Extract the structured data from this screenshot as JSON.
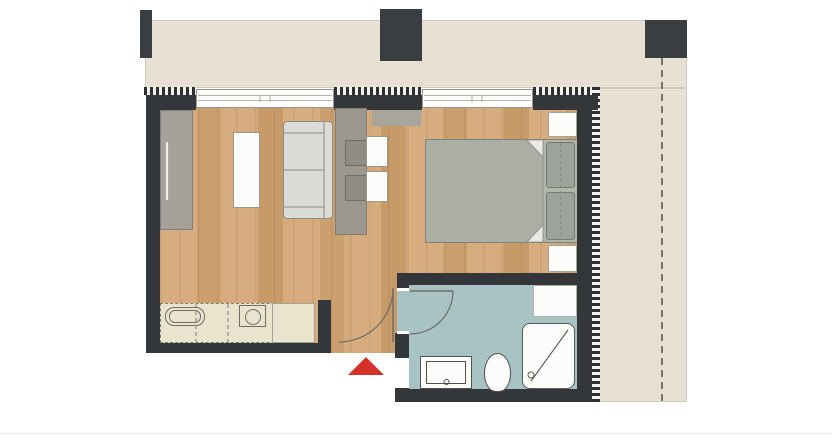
{
  "plan": {
    "title": "studio-apartment-floor-plan",
    "canvas": {
      "width": 832,
      "height": 441
    },
    "palette": {
      "bg": "#ffffff",
      "terrace": "#e7e0d3",
      "wall": "#34373a",
      "column": "#3b3e41",
      "tile": "#a8c3c3",
      "white": "#fcfcfa",
      "wardrobe": "#a4a19a",
      "partition": "#9b988f",
      "chair": "#8e8c83",
      "sofa": "#dcdcd7",
      "bed": "#abafa3",
      "bedHead": "#b2b6aa",
      "pillow": "#9da29a",
      "counter": "#eae4cf",
      "red": "#d5312a",
      "line": "#6d6d66"
    },
    "shapes": [
      {
        "name": "terrace-top",
        "x": 145,
        "y": 20,
        "w": 542,
        "h": 68,
        "cls": "terrace"
      },
      {
        "name": "terrace-right",
        "x": 598,
        "y": 88,
        "w": 89,
        "h": 314,
        "cls": "terrace"
      },
      {
        "name": "column-1",
        "x": 140,
        "y": 10,
        "w": 12,
        "h": 48,
        "fill": "$column"
      },
      {
        "name": "column-2",
        "x": 380,
        "y": 9,
        "w": 42,
        "h": 52,
        "fill": "$column"
      },
      {
        "name": "column-3",
        "x": 645,
        "y": 20,
        "w": 42,
        "h": 38,
        "fill": "$column"
      },
      {
        "name": "wood-floor",
        "x": 160,
        "y": 108,
        "w": 418,
        "h": 245,
        "cls": "wood"
      },
      {
        "name": "hatch-top-left",
        "x": 144,
        "y": 87,
        "w": 52,
        "h": 8,
        "cls": "hatch-h"
      },
      {
        "name": "hatch-top-mid",
        "x": 334,
        "y": 87,
        "w": 88,
        "h": 8,
        "cls": "hatch-h"
      },
      {
        "name": "hatch-top-right",
        "x": 533,
        "y": 87,
        "w": 66,
        "h": 8,
        "cls": "hatch-h"
      },
      {
        "name": "hatch-right",
        "x": 592,
        "y": 87,
        "w": 8,
        "h": 315,
        "cls": "hatch-v"
      },
      {
        "name": "wall-top-left",
        "x": 146,
        "y": 95,
        "w": 50,
        "h": 15,
        "fill": "$wall"
      },
      {
        "name": "wall-top-mid",
        "x": 334,
        "y": 95,
        "w": 88,
        "h": 15,
        "fill": "$wall"
      },
      {
        "name": "wall-top-right",
        "x": 533,
        "y": 95,
        "w": 65,
        "h": 15,
        "fill": "$wall"
      },
      {
        "name": "wall-left",
        "x": 146,
        "y": 95,
        "w": 14,
        "h": 258,
        "fill": "$wall"
      },
      {
        "name": "wall-kitchen-south",
        "x": 146,
        "y": 343,
        "w": 185,
        "h": 10,
        "fill": "$wall"
      },
      {
        "name": "wall-entry-stub",
        "x": 318,
        "y": 300,
        "w": 13,
        "h": 53,
        "fill": "$wall"
      },
      {
        "name": "wall-right",
        "x": 577,
        "y": 95,
        "w": 15,
        "h": 307,
        "fill": "$wall"
      },
      {
        "name": "wall-bath-north",
        "x": 397,
        "y": 273,
        "w": 181,
        "h": 12,
        "fill": "$wall"
      },
      {
        "name": "wall-bath-west-upper",
        "x": 397,
        "y": 285,
        "w": 12,
        "h": 6,
        "fill": "$wall"
      },
      {
        "name": "wall-bath-west-stub",
        "x": 395,
        "y": 333,
        "w": 16,
        "h": 25,
        "fill": "$wall"
      },
      {
        "name": "wall-bath-south",
        "x": 395,
        "y": 388,
        "w": 197,
        "h": 14,
        "fill": "$wall"
      },
      {
        "name": "window-1",
        "x": 196,
        "y": 89,
        "w": 138,
        "h": 19,
        "k": "window"
      },
      {
        "name": "window-2",
        "x": 422,
        "y": 89,
        "w": 111,
        "h": 19,
        "k": "window"
      },
      {
        "name": "bathroom-floor",
        "x": 409,
        "y": 285,
        "w": 168,
        "h": 104,
        "fill": "$tile"
      },
      {
        "name": "bathroom-doorway-floor",
        "x": 397,
        "y": 291,
        "w": 12,
        "h": 41,
        "fill": "$tile"
      },
      {
        "name": "bathroom-door-jamb-top",
        "x": 397,
        "y": 288,
        "w": 12,
        "h": 3,
        "fill": "$white"
      },
      {
        "name": "bathroom-door-jamb-bottom",
        "x": 397,
        "y": 331,
        "w": 12,
        "h": 3,
        "fill": "$white"
      },
      {
        "name": "wardrobe",
        "x": 160,
        "y": 110,
        "w": 33,
        "h": 120,
        "fill": "$wardrobe",
        "border": "1px solid #83807a"
      },
      {
        "name": "coffee-table",
        "x": 233,
        "y": 132,
        "w": 27,
        "h": 76,
        "fill": "$white",
        "border": "1px solid #9a988e"
      },
      {
        "name": "sofa",
        "x": 283,
        "y": 121,
        "w": 50,
        "h": 98,
        "fill": "$sofa",
        "border": "1px solid #8d8d86",
        "radius": "4px"
      },
      {
        "name": "partition-unit",
        "x": 335,
        "y": 108,
        "w": 32,
        "h": 127,
        "fill": "$partition",
        "border": "1px solid #807d75"
      },
      {
        "name": "wall-cabinet",
        "x": 372,
        "y": 110,
        "w": 49,
        "h": 16,
        "fill": "#a8a59c"
      },
      {
        "name": "chair-1",
        "x": 345,
        "y": 140,
        "w": 26,
        "h": 26,
        "fill": "$chair",
        "border": "1px solid #6f6d64"
      },
      {
        "name": "chair-2",
        "x": 345,
        "y": 175,
        "w": 26,
        "h": 26,
        "fill": "$chair",
        "border": "1px solid #6f6d64"
      },
      {
        "name": "desk-table-1",
        "x": 366,
        "y": 136,
        "w": 22,
        "h": 31,
        "fill": "$white",
        "border": "1px solid #9a988e"
      },
      {
        "name": "desk-table-2",
        "x": 366,
        "y": 171,
        "w": 22,
        "h": 31,
        "fill": "$white",
        "border": "1px solid #9a988e"
      },
      {
        "name": "bed",
        "x": 425,
        "y": 139,
        "w": 152,
        "h": 104,
        "fill": "$bed",
        "border": "1px solid #7f8278"
      },
      {
        "name": "bed-head-strip",
        "x": 543,
        "y": 140,
        "w": 34,
        "h": 102,
        "fill": "$bedHead"
      },
      {
        "name": "pillow-1",
        "x": 546,
        "y": 142,
        "w": 29,
        "h": 46,
        "fill": "$pillow",
        "border": "1px solid #767b72",
        "radius": "3px"
      },
      {
        "name": "pillow-2",
        "x": 546,
        "y": 192,
        "w": 29,
        "h": 48,
        "fill": "$pillow",
        "border": "1px solid #767b72",
        "radius": "3px"
      },
      {
        "name": "nightstand-top",
        "x": 548,
        "y": 112,
        "w": 29,
        "h": 25,
        "fill": "$white",
        "border": "1px solid #a5a39b"
      },
      {
        "name": "nightstand-bottom",
        "x": 548,
        "y": 245,
        "w": 29,
        "h": 27,
        "fill": "$white",
        "border": "1px solid #a5a39b"
      },
      {
        "name": "kitchen-counter",
        "x": 160,
        "y": 303,
        "w": 155,
        "h": 40,
        "fill": "$counter",
        "border": "1.5px dashed #7c7b6e"
      },
      {
        "name": "kitchen-counter-end",
        "x": 272,
        "y": 303,
        "w": 43,
        "h": 40,
        "fill": "$counter",
        "border": "1px solid #a3a193"
      },
      {
        "name": "cooktop-outer",
        "x": 165,
        "y": 307,
        "w": 40,
        "h": 19,
        "border": "1.2px solid #6f6e62",
        "radius": "9px"
      },
      {
        "name": "cooktop-inner",
        "x": 169,
        "y": 310,
        "w": 32,
        "h": 13,
        "border": "1px solid #6f6e62",
        "radius": "6px"
      },
      {
        "name": "sink-box",
        "x": 239,
        "y": 305,
        "w": 27,
        "h": 22,
        "border": "1px solid #6f6e62"
      },
      {
        "name": "sink-bowl",
        "x": 245,
        "y": 309,
        "w": 16,
        "h": 16,
        "border": "1px solid #6f6e62",
        "radius": "50%"
      },
      {
        "name": "bathroom-cabinet",
        "x": 533,
        "y": 285,
        "w": 44,
        "h": 32,
        "fill": "$white",
        "border": "1px solid #b3b1a9"
      },
      {
        "name": "shower-tray",
        "x": 522,
        "y": 323,
        "w": 53,
        "h": 66,
        "fill": "$white",
        "border": "1.5px solid #5b5b55",
        "radius": "8px"
      },
      {
        "name": "washbasin",
        "x": 420,
        "y": 356,
        "w": 52,
        "h": 33,
        "fill": "$white",
        "border": "1.2px solid #53534d"
      },
      {
        "name": "washbasin-inner",
        "x": 426,
        "y": 361,
        "w": 40,
        "h": 23,
        "border": "1px solid #53534d"
      },
      {
        "name": "toilet",
        "x": 484,
        "y": 353,
        "w": 27,
        "h": 39,
        "fill": "$white",
        "border": "1.2px solid #53534d",
        "radius": "50% 50% 42% 42% / 52% 52% 48% 48%"
      },
      {
        "name": "page-rule",
        "x": 0,
        "y": 433,
        "w": 832,
        "h": 1,
        "fill": "#e8e7e3"
      }
    ],
    "svg_paths": [
      {
        "name": "entry-door-leaf",
        "d": "M393,288 L393,342",
        "stroke": "$line",
        "w": 1.4
      },
      {
        "name": "entry-door-arc",
        "d": "M339,342 A54,54 0 0 0 393,288",
        "stroke": "$line",
        "w": 1.2
      },
      {
        "name": "bathroom-door-leaf",
        "d": "M410,291 L453,291",
        "stroke": "$line",
        "w": 1.4
      },
      {
        "name": "bathroom-door-arc",
        "d": "M453,291 A43,43 0 0 1 410,334",
        "stroke": "$line",
        "w": 1.2
      },
      {
        "name": "counter-divider-1",
        "d": "M196,304 L196,342",
        "stroke": "#7c7b6e",
        "w": 1,
        "dash": "4 3"
      },
      {
        "name": "counter-divider-2",
        "d": "M228,304 L228,342",
        "stroke": "#7c7b6e",
        "w": 1,
        "dash": "4 3"
      },
      {
        "name": "wardrobe-handle",
        "d": "M167,142 L167,200",
        "stroke": "#efefe9",
        "w": 2.2
      },
      {
        "name": "sofa-backrest-line",
        "d": "M324,122 L324,218",
        "stroke": "#8d8d86",
        "w": 1
      },
      {
        "name": "sofa-armrest-top-line",
        "d": "M284,133 L324,133",
        "stroke": "#8d8d86",
        "w": 1
      },
      {
        "name": "sofa-seat-divider-line",
        "d": "M284,170 L324,170",
        "stroke": "#8d8d86",
        "w": 1
      },
      {
        "name": "sofa-armrest-bottom-line",
        "d": "M284,207 L324,207",
        "stroke": "#8d8d86",
        "w": 1
      },
      {
        "name": "bed-head-line",
        "d": "M543,140 L543,242",
        "stroke": "#8a8d82",
        "w": 0.8
      },
      {
        "name": "duvet-fold-top",
        "d": "M543,140 L527,140 L543,157 Z",
        "stroke": "#8a8d82",
        "w": 0.8,
        "fill": "#eae9e3"
      },
      {
        "name": "duvet-fold-bottom",
        "d": "M543,242 L527,242 L543,225 Z",
        "stroke": "#8a8d82",
        "w": 0.8,
        "fill": "#eae9e3"
      },
      {
        "name": "pillow-split-line",
        "d": "M560.5,143 L560.5,239",
        "stroke": "#82877e",
        "w": 0.8,
        "dash": "3 3"
      },
      {
        "name": "shower-diagonal",
        "d": "M531,381 L568,330",
        "stroke": "#5b5b55",
        "w": 1.1
      },
      {
        "name": "shower-drain",
        "d": "M528,375 a3,3 0 1 0 6,0 a3,3 0 1 0 -6,0",
        "stroke": "#5b5b55",
        "w": 1
      },
      {
        "name": "washbasin-faucet",
        "d": "M444,382 a2.5,2.5 0 1 0 5,0 a2.5,2.5 0 1 0 -5,0",
        "stroke": "#53534d",
        "w": 1
      },
      {
        "name": "toilet-feet",
        "d": "M489,391.5 L494,391.5 M501,391.5 L506,391.5",
        "stroke": "#3a3a36",
        "w": 2
      },
      {
        "name": "window-1-ticks",
        "d": "M260,96 L260,102 M270,96 L270,102",
        "stroke": "#97978f",
        "w": 0.8
      },
      {
        "name": "window-2-ticks",
        "d": "M472,96 L472,102 M482,96 L482,102",
        "stroke": "#97978f",
        "w": 0.8
      },
      {
        "name": "site-boundary-dashed-line",
        "d": "M662,58 L662,402",
        "stroke": "#504f49",
        "w": 1.5,
        "dash": "7 5"
      },
      {
        "name": "entrance-arrow",
        "d": "M348,375 L384,375 L366,357 Z",
        "stroke": "none",
        "w": 0,
        "fill": "$red"
      }
    ]
  }
}
